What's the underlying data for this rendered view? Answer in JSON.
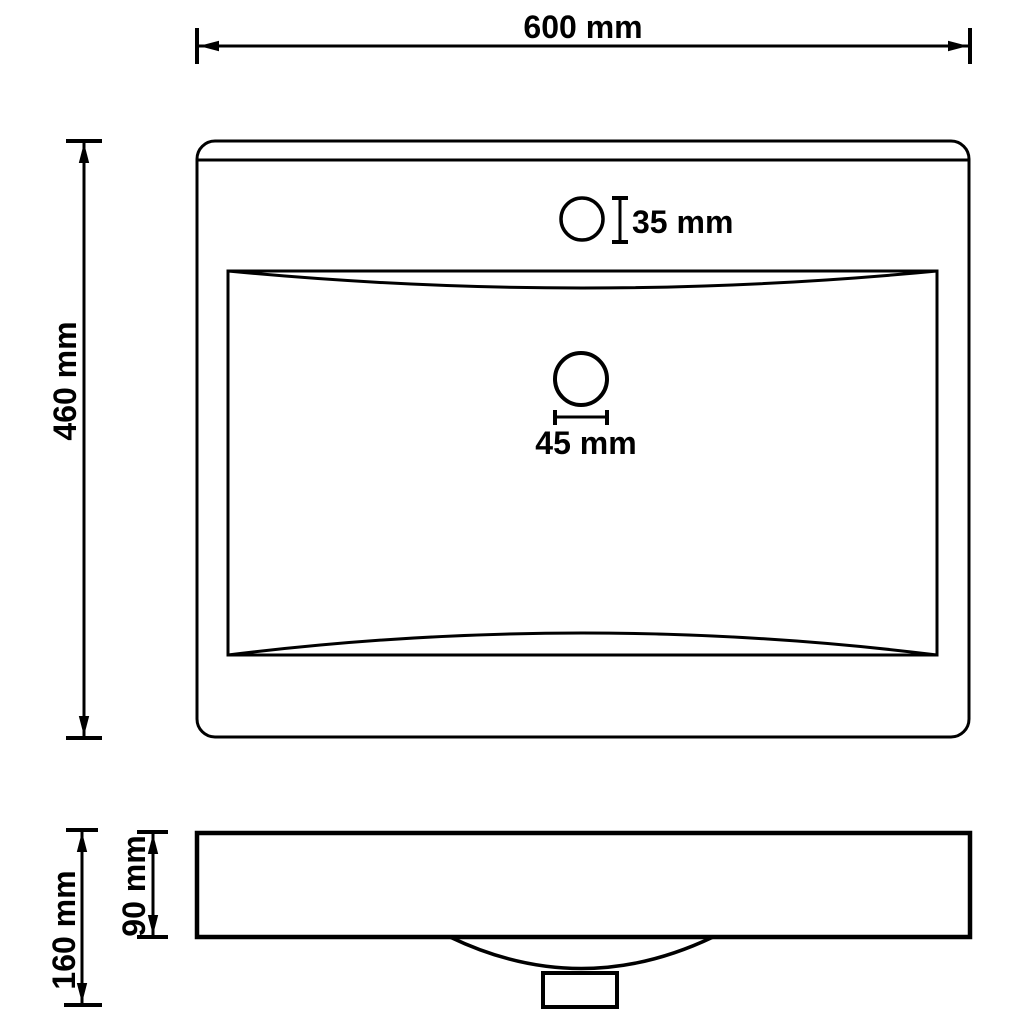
{
  "colors": {
    "background": "#ffffff",
    "line": "#000000",
    "text": "#000000"
  },
  "drawing_type": "washbasin dimension drawing",
  "top_view": {
    "width_dim": "600 mm",
    "depth_dim": "460 mm",
    "faucet_hole_dim": "35 mm",
    "drain_hole_dim": "45 mm"
  },
  "front_view": {
    "total_height_dim": "160 mm",
    "rim_height_dim": "90 mm"
  }
}
